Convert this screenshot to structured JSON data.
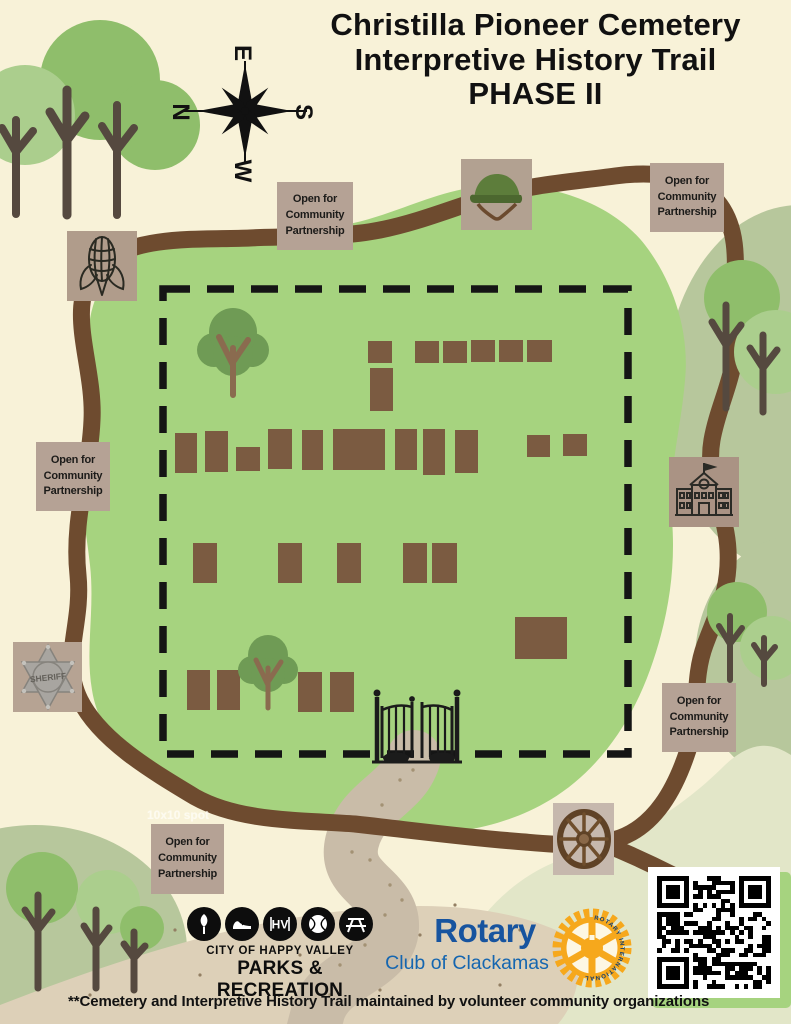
{
  "title": {
    "line1": "Christilla Pioneer Cemetery",
    "line2": "Interpretive History Trail",
    "line3": "PHASE II"
  },
  "compass": {
    "north": "N",
    "east": "E",
    "south": "S",
    "west": "W"
  },
  "map": {
    "partnership_label": "Open for Community Partnership",
    "spot_note": "10x10 spot",
    "sheriff_badge_text": "SHERIFF",
    "icons": {
      "corn": "corn-icon",
      "helmet": "army-helmet-icon",
      "sheriff": "sheriff-badge-icon",
      "school": "schoolhouse-icon",
      "wagon_wheel": "wagon-wheel-icon",
      "gate": "cemetery-gate-icon",
      "compass": "compass-rose-icon",
      "qr": "qr-code"
    }
  },
  "colors": {
    "background": "#f8f2d8",
    "cemetery_green": "#a6d37f",
    "sage": "#b7c79c",
    "pale_sage": "#e2e6c8",
    "trail_brown": "#6e4b2f",
    "path_tan": "#c9bca8",
    "plot_brown": "#7b5b41",
    "label_tan": "#b5a295",
    "rotary_blue": "#17549f",
    "rotary_gold": "#f6a81c"
  },
  "logos": {
    "happy_valley": {
      "line1": "CITY OF HAPPY VALLEY",
      "line2": "PARKS & RECREATION",
      "monogram": "HV"
    },
    "rotary": {
      "name": "Rotary",
      "club": "Club of Clackamas",
      "wheel_text": "ROTARY INTERNATIONAL"
    }
  },
  "footer": {
    "note": "**Cemetery and Interpretive History Trail maintained by volunteer community organizations"
  }
}
